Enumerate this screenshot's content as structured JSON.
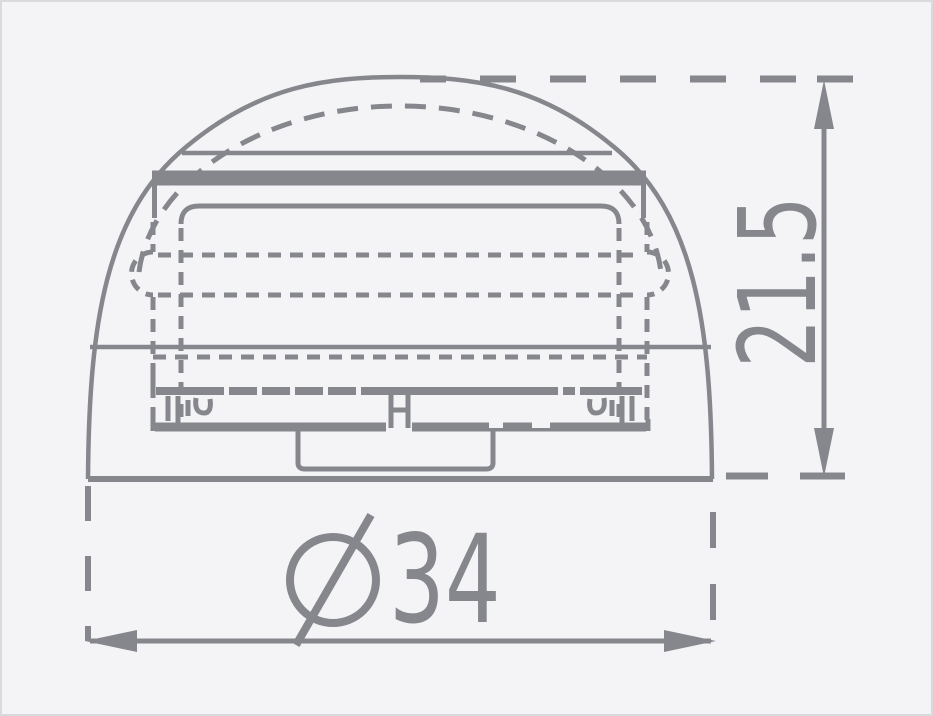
{
  "diagram": {
    "type": "technical-dimension-drawing",
    "subject": "dome-beacon-side-view",
    "colors": {
      "background": "#f4f4f6",
      "stroke": "#85878d",
      "frame": "#d9dadc"
    },
    "dimensions": {
      "height": {
        "label": "21.5",
        "orientation": "vertical",
        "unit": ""
      },
      "diameter": {
        "prefix": "Ø",
        "value": "34",
        "display": "Ø34",
        "orientation": "horizontal",
        "unit": ""
      }
    }
  }
}
